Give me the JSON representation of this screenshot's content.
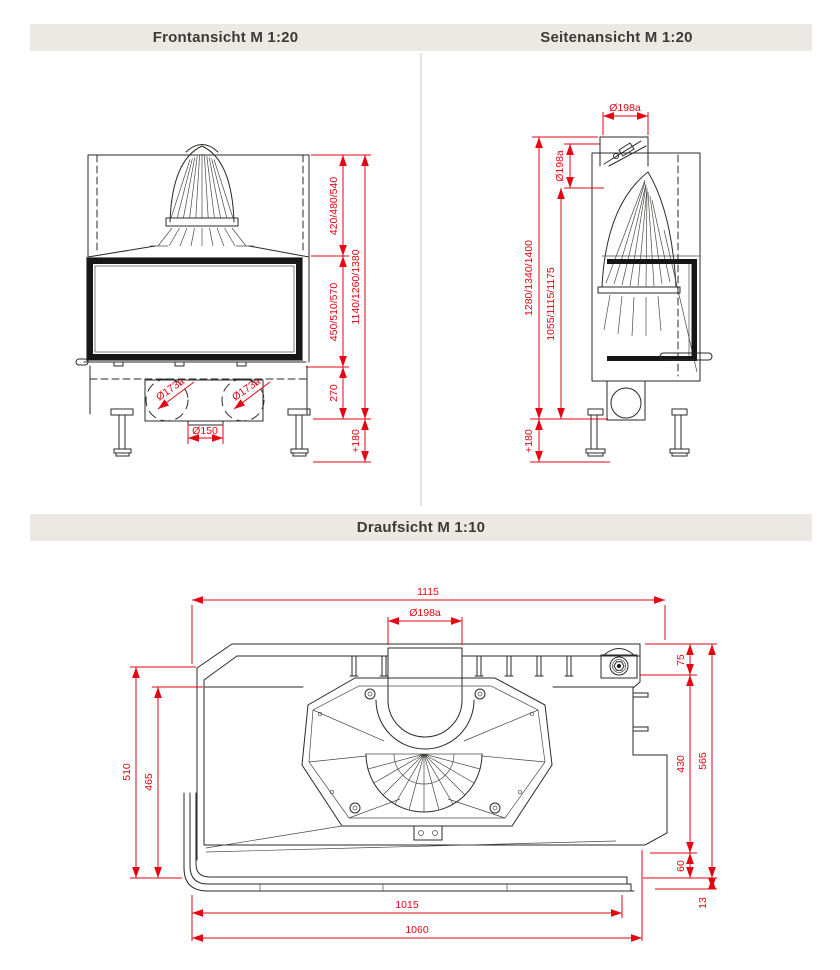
{
  "headers": {
    "front": "Frontansicht M 1:20",
    "side": "Seitenansicht M 1:20",
    "top": "Draufsicht M 1:10"
  },
  "colors": {
    "dimension": "#E30613",
    "line": "#2B2A28",
    "header_bg": "#ECE9E4"
  },
  "front_view": {
    "dims": {
      "upper": "420/480/540",
      "window": "450/510/570",
      "base": "270",
      "total": "1140/1260/1380",
      "feet": "+180",
      "flue_left": "Ø173a",
      "flue_right": "Ø173a",
      "air": "Ø150"
    }
  },
  "side_view": {
    "dims": {
      "flue_top": "Ø198a",
      "flue_side": "Ø198a",
      "total": "1280/1340/1400",
      "body": "1055/1115/1175",
      "feet": "+180"
    }
  },
  "top_view": {
    "dims": {
      "width_total": "1115",
      "flue": "Ø198a",
      "depth_top": "75",
      "depth_mid": "430",
      "depth_total": "565",
      "depth_bottom": "60",
      "frame": "13",
      "left_outer": "510",
      "left_inner": "465",
      "bottom_inner": "1015",
      "bottom_outer": "1060"
    }
  }
}
